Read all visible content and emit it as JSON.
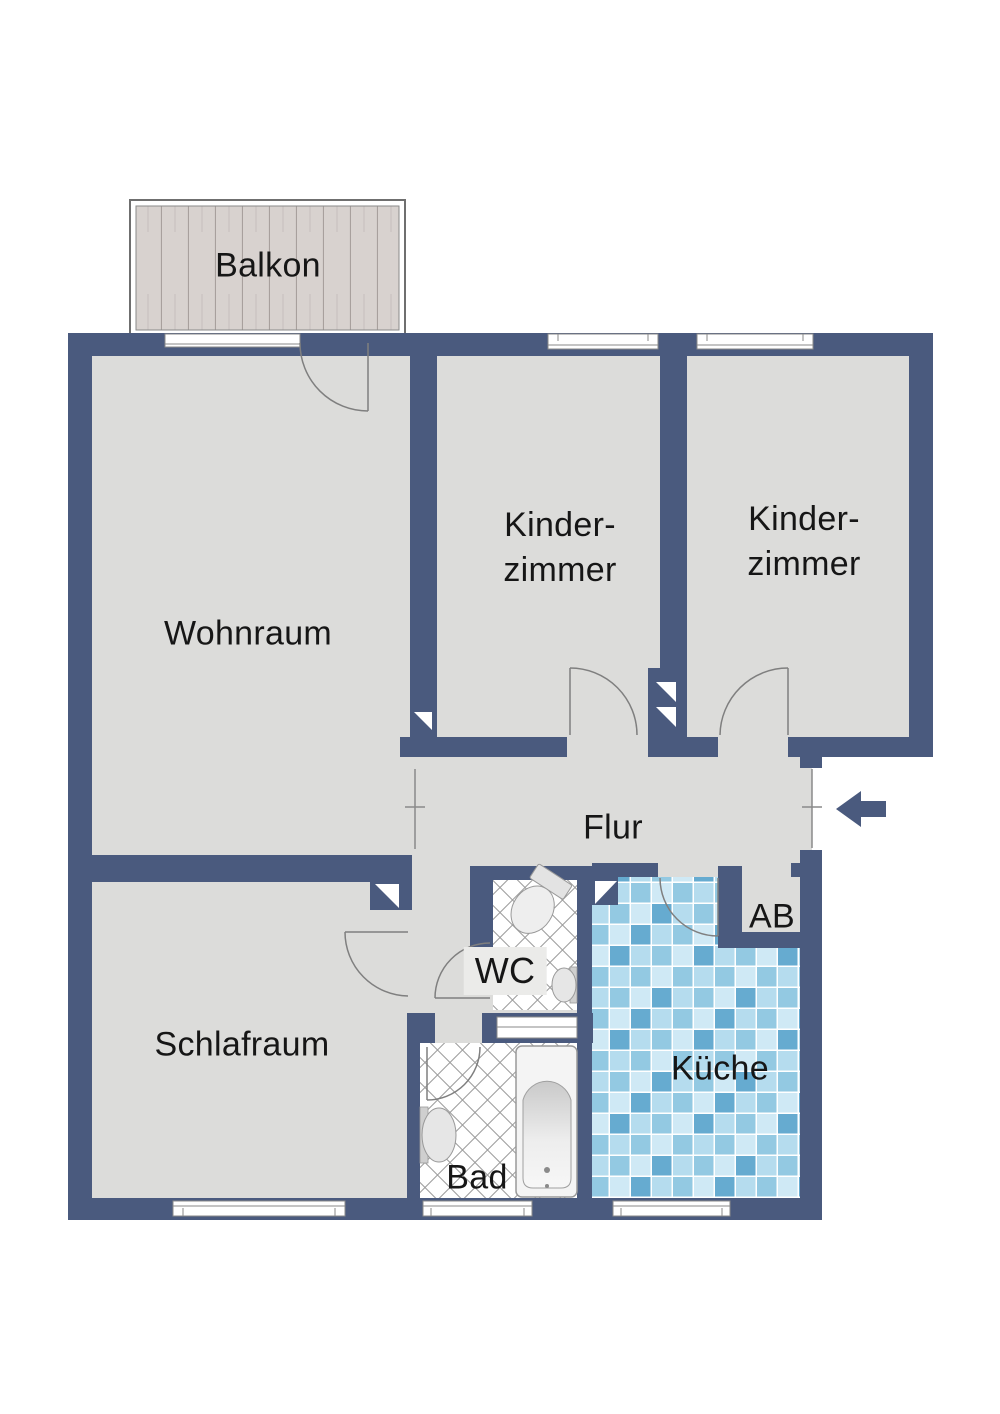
{
  "rooms": {
    "balkon": {
      "label": "Balkon"
    },
    "wohnraum": {
      "label": "Wohnraum"
    },
    "kinderzimmer_mitte": {
      "line1": "Kinder-",
      "line2": "zimmer"
    },
    "kinderzimmer_rechts": {
      "line1": "Kinder-",
      "line2": "zimmer"
    },
    "flur": {
      "label": "Flur"
    },
    "schlafraum": {
      "label": "Schlafraum"
    },
    "wc": {
      "label": "WC"
    },
    "bad": {
      "label": "Bad"
    },
    "kueche": {
      "label": "Küche"
    },
    "abstellraum": {
      "label": "AB"
    }
  },
  "colors": {
    "wall": "#4a5a7e",
    "floor": "#dcdcda",
    "balcony_wood": "#d8d2cf",
    "balcony_wood_line": "#a8a09d",
    "door_line": "#7f7f7f",
    "bath_tile_line": "#9c9c9c",
    "tile_light": "#cfe9f5",
    "tile_pale": "#b5dcee",
    "tile_medium": "#93c9e2",
    "tile_dark": "#66abd0",
    "fixture_fill": "#ececec",
    "fixture_stroke": "#999999"
  }
}
